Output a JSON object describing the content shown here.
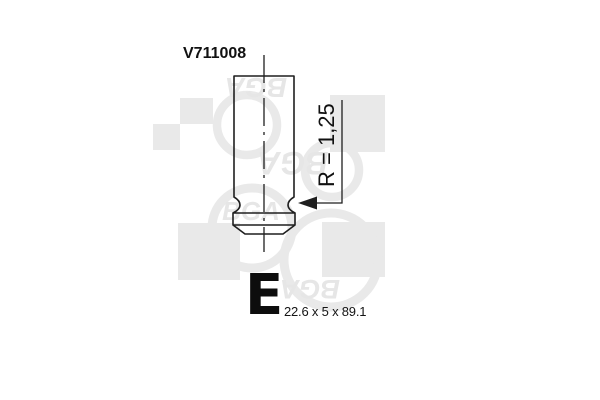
{
  "image": {
    "background": "#ffffff",
    "line_color": "#1f1f1f",
    "watermark_color": "#e9e9e9"
  },
  "part": {
    "number": "V711008",
    "type_letter": "E",
    "dimensions": "22.6 x 5 x 89.1",
    "fillet_radius_label": "R = 1,25"
  },
  "watermark": {
    "brand": "BGA"
  }
}
